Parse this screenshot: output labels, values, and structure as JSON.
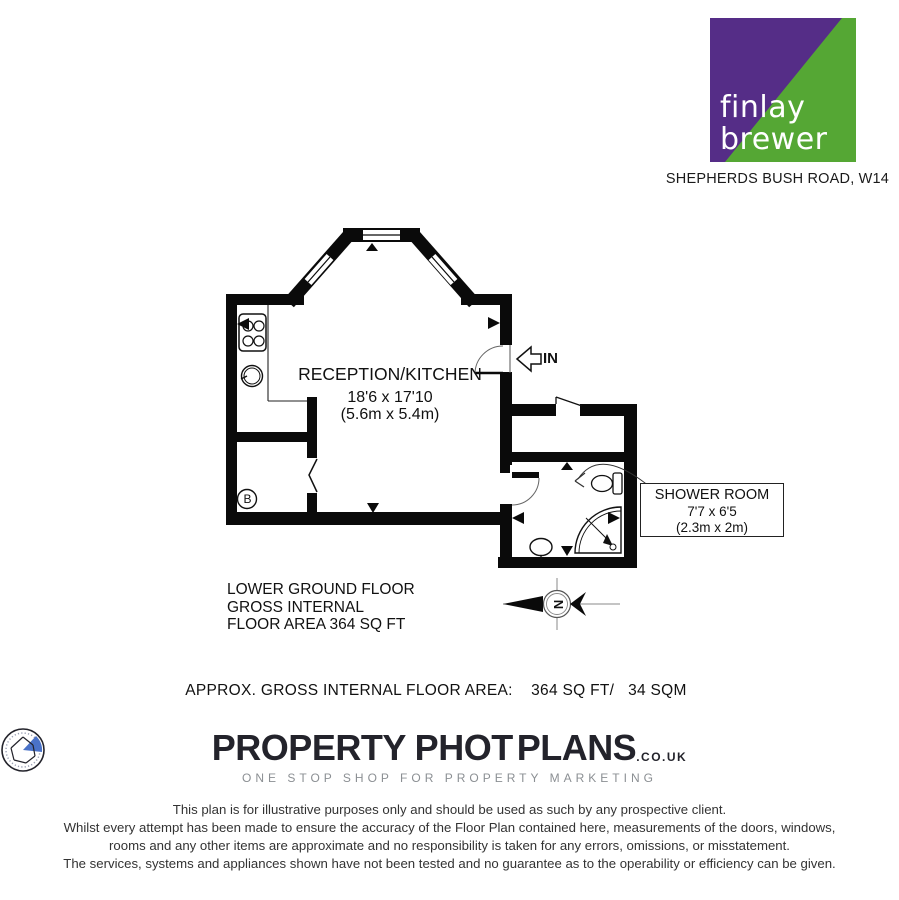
{
  "agency": {
    "name_line1": "finlay",
    "name_line2": "brewer",
    "address": "SHEPHERDS BUSH ROAD, W14",
    "brand_purple": "#552d87",
    "brand_green": "#55a734"
  },
  "floorplan": {
    "reception": {
      "name": "RECEPTION/KITCHEN",
      "dims_imperial": "18'6 x 17'10",
      "dims_metric": "(5.6m x 5.4m)"
    },
    "shower": {
      "name": "SHOWER ROOM",
      "dims_imperial": "7'7 x 6'5",
      "dims_metric": "(2.3m x 2m)"
    },
    "entrance_label": "IN",
    "boiler_label": "B",
    "compass_label": "N",
    "floor_title": [
      "LOWER GROUND FLOOR",
      "GROSS INTERNAL",
      "FLOOR AREA 364 SQ FT"
    ]
  },
  "area_line": "APPROX. GROSS INTERNAL FLOOR AREA:    364 SQ FT/   34 SQM",
  "branding": {
    "logo_left": "PROPERTY PHOT",
    "logo_right": "PLANS",
    "logo_tld": ".CO.UK",
    "tagline": "ONE STOP SHOP FOR PROPERTY MARKETING"
  },
  "disclaimer": {
    "lines": [
      "This plan is for illustrative purposes only and should be used as such by any prospective client.",
      "Whilst every attempt has been made to ensure the accuracy of the Floor Plan contained here, measurements of the doors, windows,",
      "rooms and any other items are approximate and no responsibility is taken for any errors, omissions, or misstatement.",
      "The services, systems and appliances shown have not been tested and no guarantee as to the operability or efficiency can be given."
    ]
  }
}
